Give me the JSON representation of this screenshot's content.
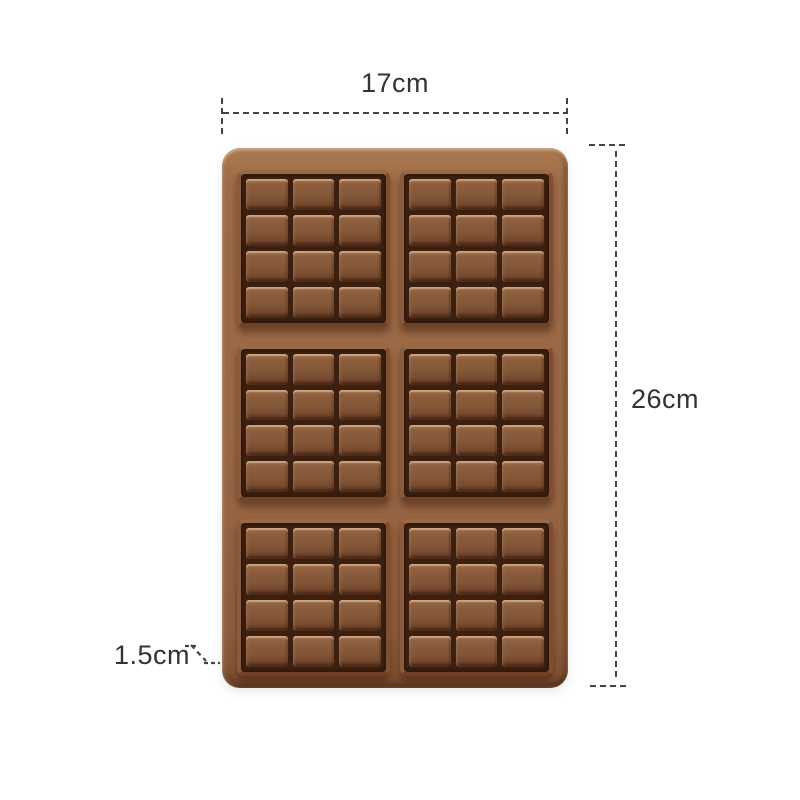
{
  "page": {
    "background": "#ffffff",
    "type": "product-dimension-diagram"
  },
  "dimensions": {
    "width": {
      "label": "17cm"
    },
    "height": {
      "label": "26cm"
    },
    "depth": {
      "label": "1.5cm"
    }
  },
  "mold": {
    "description": "6-cavity chocolate bar silicone mold",
    "bar_count": 6,
    "bar_grid": {
      "rows": 3,
      "columns": 2
    },
    "cells_per_bar": {
      "rows": 4,
      "columns": 3
    },
    "colors": {
      "tray": "#9a6845",
      "bar_rim": "#8a5a3a",
      "groove": "#3c1f0e",
      "cell": "#835738",
      "cell_highlight": "#b98a60",
      "dimension_line": "#444444",
      "text": "#333333",
      "background": "#ffffff"
    }
  }
}
